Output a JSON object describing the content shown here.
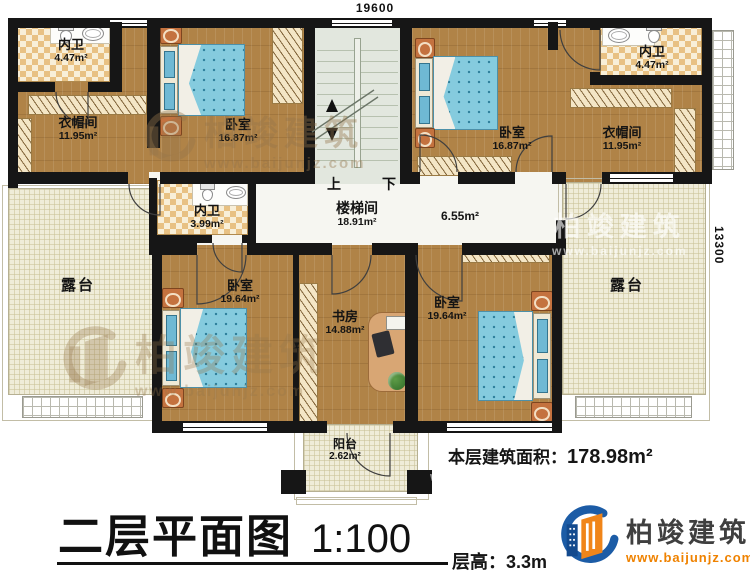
{
  "dimensions": {
    "width_mm": "19600",
    "height_mm": "13300"
  },
  "rooms": {
    "bath_tl": {
      "label": "内卫",
      "area": "4.47m²"
    },
    "closet_tl": {
      "label": "衣帽间",
      "area": "11.95m²"
    },
    "bedroom_tl": {
      "label": "卧室",
      "area": "16.87m²"
    },
    "stairwell": {
      "label": "楼梯间",
      "area": "18.91m²"
    },
    "corridor": {
      "area": "6.55m²"
    },
    "bedroom_tr": {
      "label": "卧室",
      "area": "16.87m²"
    },
    "closet_tr": {
      "label": "衣帽间",
      "area": "11.95m²"
    },
    "bath_tr": {
      "label": "内卫",
      "area": "4.47m²"
    },
    "bath_mid": {
      "label": "内卫",
      "area": "3.99m²"
    },
    "terrace_left": {
      "label": "露台"
    },
    "terrace_right": {
      "label": "露台"
    },
    "bedroom_bl": {
      "label": "卧室",
      "area": "19.64m²"
    },
    "study": {
      "label": "书房",
      "area": "14.88m²"
    },
    "bedroom_br": {
      "label": "卧室",
      "area": "19.64m²"
    },
    "balcony": {
      "label": "阳台",
      "area": "2.62m²"
    }
  },
  "stairs": {
    "up": "上",
    "down": "下"
  },
  "footer": {
    "area_label": "本层建筑面积：",
    "area_value": "178.98m²",
    "title": "二层平面图",
    "scale": "1:100",
    "floor_height": "层高：3.3m"
  },
  "brand": {
    "name": "柏竣建筑",
    "website": "www.baijunjz.com"
  }
}
